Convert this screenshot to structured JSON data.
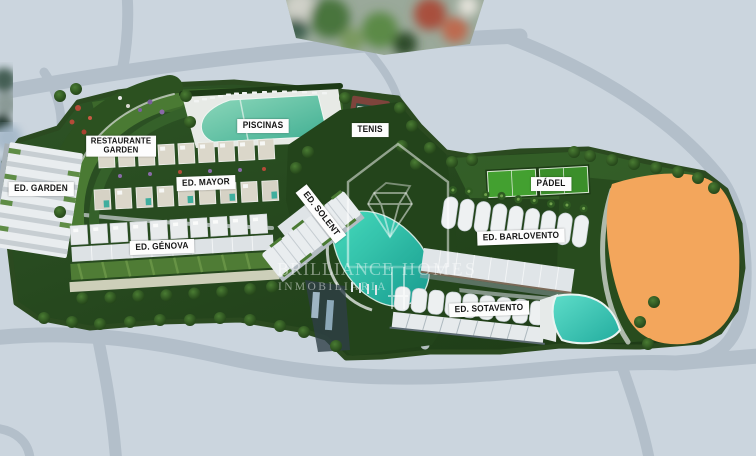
{
  "watermark": {
    "brand_1": "BRILLIANCE",
    "brand_2": "HOMES",
    "tagline": "INMOBILIARIA",
    "logo": "diamond-inside-house-outline"
  },
  "labels": {
    "buildings": {
      "garden": "ED. GARDEN",
      "mayor": "ED. MAYOR",
      "genova": "ED. GÉNOVA",
      "solent": "ED. SOLENT",
      "barlovento": "ED. BARLOVENTO",
      "sotavento": "ED. SOTAVENTO"
    },
    "amenities": {
      "restaurante_line1": "RESTAURANTE",
      "restaurante_line2": "GARDEN",
      "piscinas": "PISCINAS",
      "tenis": "TENIS",
      "padel": "PÁDEL"
    }
  },
  "colors": {
    "road": "#b3bfca",
    "block": "#cbd5de",
    "site_green": "#2a4d20",
    "pool_teal": "#3fc9b0",
    "accent_orange": "#f3a65c",
    "tennis_court": "#2b5340",
    "tennis_border": "#7e443c",
    "padel_green": "#43a030",
    "label_bg": "#fdfdfd",
    "label_text": "#141414"
  }
}
